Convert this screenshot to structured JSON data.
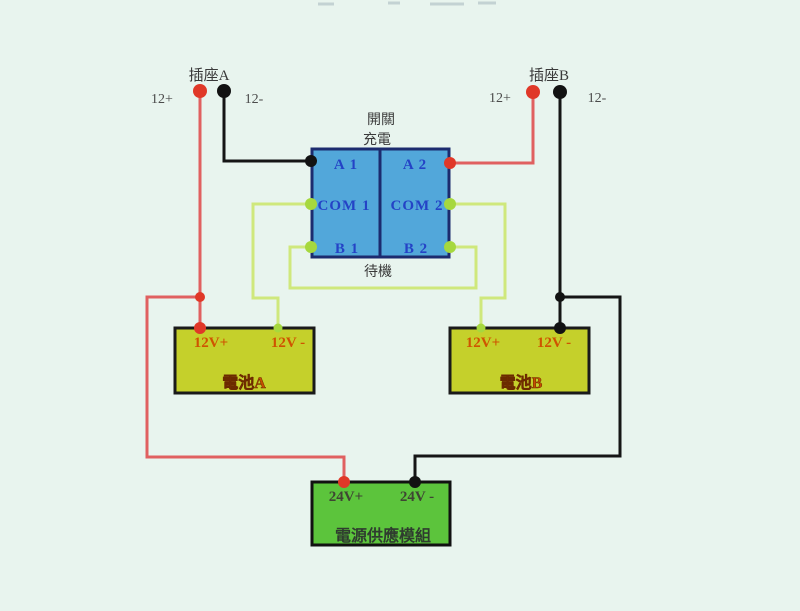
{
  "colors": {
    "background": "#e8f4ee",
    "wire_red": "#e06060",
    "wire_black": "#151515",
    "wire_green": "#cfe87c",
    "dot_red": "#e03828",
    "dot_black": "#121212",
    "dot_green": "#a6d83e",
    "switch_fill": "#52a7da",
    "switch_border": "#1c2b6e",
    "switch_text": "#2443c6",
    "battery_fill": "#c5d02b",
    "battery_border": "#1a1a1a",
    "battery_text": "#cf5400",
    "power_fill": "#5cc43c",
    "power_border": "#111111",
    "power_text": "#3f4533",
    "label_text": "#3a3a3a"
  },
  "sockets": {
    "a": {
      "name": "插座A",
      "pos": "12+",
      "neg": "12-"
    },
    "b": {
      "name": "插座B",
      "pos": "12+",
      "neg": "12-"
    }
  },
  "switch": {
    "mode_top": "開關",
    "mode_charge": "充電",
    "mode_standby": "待機",
    "cells": {
      "a1": "A 1",
      "a2": "A 2",
      "com1": "COM 1",
      "com2": "COM 2",
      "b1": "B 1",
      "b2": "B 2"
    }
  },
  "battery_a": {
    "pos": "12V+",
    "neg": "12V -",
    "name": "電池A"
  },
  "battery_b": {
    "pos": "12V+",
    "neg": "12V -",
    "name": "電池B"
  },
  "power_module": {
    "pos": "24V+",
    "neg": "24V -",
    "name": "電源供應模組"
  }
}
